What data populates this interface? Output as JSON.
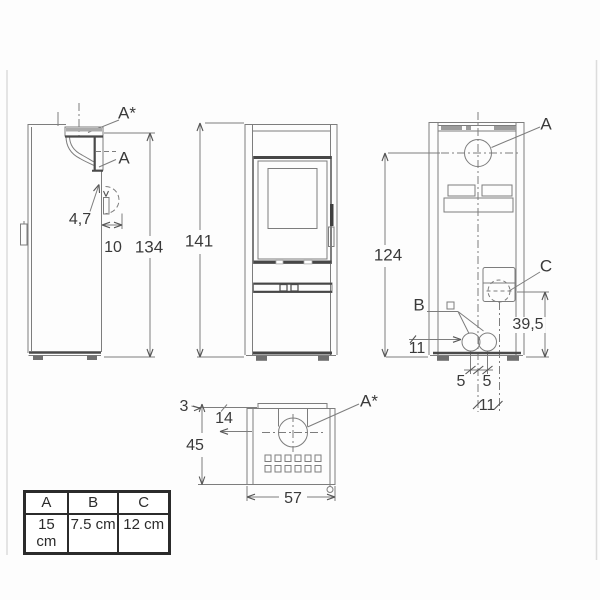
{
  "drawing": {
    "side_view": {
      "label_top_outlet": "A*",
      "label_rear_outlet": "A",
      "dim_pipe_gap": "4,7",
      "dim_pipe_offset": "10",
      "dim_height": "134"
    },
    "front_view": {
      "dim_height": "141"
    },
    "rear_view": {
      "label_flue": "A",
      "label_connection_b": "B",
      "label_connection_c": "C",
      "dim_flue_height": "124",
      "dim_c_height": "39,5",
      "dim_b_height": "11",
      "dim_b_offset_left": "5",
      "dim_b_offset_right": "5",
      "dim_c_offset": "11"
    },
    "top_view": {
      "label_top_outlet": "A*",
      "dim_shield_gap": "3",
      "dim_flue_offset": "14",
      "dim_depth": "45",
      "dim_width": "57"
    }
  },
  "legend_table": {
    "headers": [
      "A",
      "B",
      "C"
    ],
    "values": [
      "15 cm",
      "7.5 cm",
      "12 cm"
    ]
  }
}
